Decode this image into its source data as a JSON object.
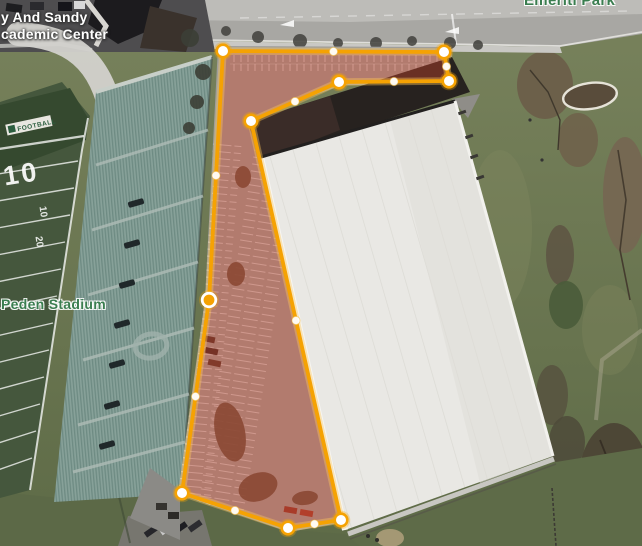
{
  "labels": {
    "academic_center_line1": "y And Sandy",
    "academic_center_line2": "cademic Center",
    "peden_stadium": "Peden Stadium",
    "emeriti_park": "Emeriti Park"
  },
  "field": {
    "football_sign": "FOOTBALL",
    "number_large": "10",
    "number_small_1": "10",
    "number_small_2": "20"
  },
  "overlay": {
    "stroke_color": "#F5A203",
    "halo_color": "rgba(255,200,90,0.40)",
    "fill_color": "rgba(205,70,45,0.40)",
    "vertex_fill": "#FFFFFF",
    "selected_vertex_fill": "#F5A203",
    "selected_index": 8,
    "vertices": [
      {
        "x": 223,
        "y": 51
      },
      {
        "x": 444,
        "y": 52
      },
      {
        "x": 449,
        "y": 81
      },
      {
        "x": 339,
        "y": 82
      },
      {
        "x": 251,
        "y": 121
      },
      {
        "x": 341,
        "y": 520
      },
      {
        "x": 288,
        "y": 528
      },
      {
        "x": 182,
        "y": 493
      },
      {
        "x": 209,
        "y": 300
      }
    ]
  }
}
